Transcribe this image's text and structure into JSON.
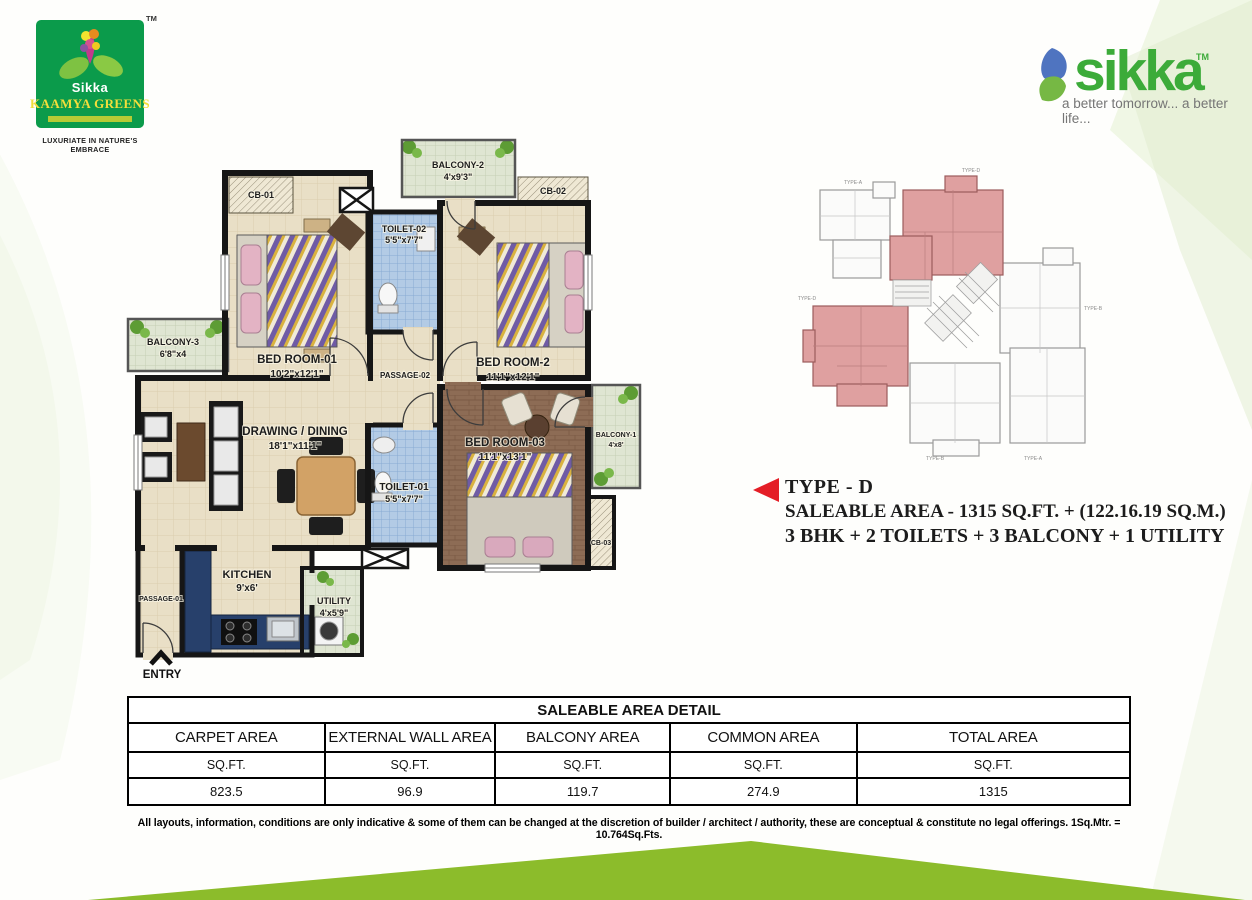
{
  "brand_left": {
    "tm": "TM",
    "name_top": "Sikka",
    "name_main": "KAAMYA GREENS",
    "tagline": "LUXURIATE IN NATURE'S EMBRACE"
  },
  "brand_right": {
    "name": "sikka",
    "tm": "TM",
    "tagline": "a better tomorrow... a better life..."
  },
  "type_info": {
    "title": "TYPE - D",
    "area_line": "SALEABLE AREA - 1315 SQ.FT. + (122.16.19 SQ.M.)",
    "config_line": "3 BHK + 2 TOILETS + 3 BALCONY + 1 UTILITY"
  },
  "floor_plan": {
    "entry": "ENTRY",
    "rooms": {
      "balcony2": {
        "name": "BALCONY-2",
        "dims": "4'x9'3\""
      },
      "cb01": {
        "name": "CB-01"
      },
      "toilet2": {
        "name": "TOILET-02",
        "dims": "5'5\"x7'7\""
      },
      "cb02": {
        "name": "CB-02"
      },
      "bedroom1": {
        "name": "BED ROOM-01",
        "dims": "10'2\"x12'1\""
      },
      "bedroom2": {
        "name": "BED ROOM-2",
        "dims": "11'1\"x12'1\""
      },
      "balcony3": {
        "name": "BALCONY-3",
        "dims": "6'8\"x4"
      },
      "passage2": {
        "name": "PASSAGE-02"
      },
      "drawing": {
        "name": "DRAWING / DINING",
        "dims": "18'1\"x11'1\""
      },
      "toilet1": {
        "name": "TOILET-01",
        "dims": "5'5\"x7'7\""
      },
      "bedroom3": {
        "name": "BED ROOM-03",
        "dims": "11'1\"x13'1\""
      },
      "balcony1": {
        "name": "BALCONY-1",
        "dims": "4'x8'"
      },
      "cb03": {
        "name": "CB-03"
      },
      "kitchen": {
        "name": "KITCHEN",
        "dims": "9'x6'"
      },
      "utility": {
        "name": "UTILITY",
        "dims": "4'x5'9\""
      },
      "passage1": {
        "name": "PASSAGE-01"
      }
    }
  },
  "key_plan": {
    "labels": [
      "TYPE-A",
      "TYPE-D",
      "TYPE-D",
      "TYPE-B",
      "TYPE-B",
      "TYPE-A"
    ]
  },
  "area_table": {
    "title": "SALEABLE AREA DETAIL",
    "columns": [
      "CARPET AREA",
      "EXTERNAL WALL AREA",
      "BALCONY AREA",
      "COMMON AREA",
      "TOTAL AREA"
    ],
    "units": [
      "SQ.FT.",
      "SQ.FT.",
      "SQ.FT.",
      "SQ.FT.",
      "SQ.FT."
    ],
    "values": [
      "823.5",
      "96.9",
      "119.7",
      "274.9",
      "1315"
    ]
  },
  "disclaimer": "All layouts, information, conditions are only indicative & some of them can be changed at the discretion of builder / architect / authority, these are conceptual & constitute no legal offerings. 1Sq.Mtr. = 10.764Sq.Fts.",
  "colors": {
    "brand_green": "#3cab39",
    "logo_green": "#0b9b4b",
    "accent_red": "#e41e26",
    "band_green": "#8cbc2b",
    "keyplan_highlight": "#dfa0a0"
  }
}
